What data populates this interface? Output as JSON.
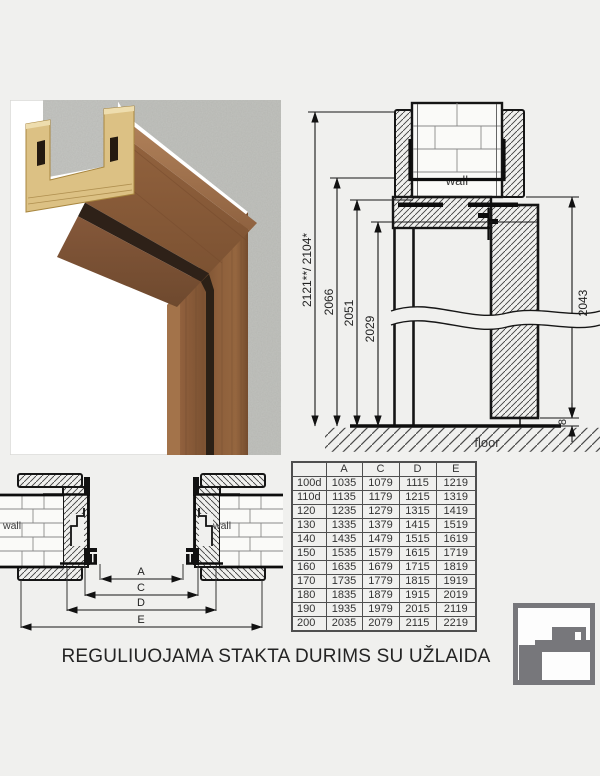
{
  "caption": "REGULIUOJAMA STAKTA DURIMS SU UŽLAIDA",
  "colors": {
    "background": "#f0f0ee",
    "line": "#161616",
    "logo_gray": "#77777b",
    "table_border": "#4f4f4f"
  },
  "section_view": {
    "wall_label": "wall",
    "floor_label": "floor",
    "dim_total": "2121**/ 2104*",
    "dim_frame_outer": "2066",
    "dim_frame_inner": "2051",
    "dim_opening": "2029",
    "dim_door": "2043",
    "dim_floor_gap": "8"
  },
  "plan_view": {
    "wall_label_left": "wall",
    "wall_label_right": "wall",
    "dim_a": "A",
    "dim_c": "C",
    "dim_d": "D",
    "dim_e": "E"
  },
  "table": {
    "columns": [
      "",
      "A",
      "C",
      "D",
      "E"
    ],
    "rows": [
      [
        "100d",
        "1035",
        "1079",
        "1115",
        "1219"
      ],
      [
        "110d",
        "1135",
        "1179",
        "1215",
        "1319"
      ],
      [
        "120",
        "1235",
        "1279",
        "1315",
        "1419"
      ],
      [
        "130",
        "1335",
        "1379",
        "1415",
        "1519"
      ],
      [
        "140",
        "1435",
        "1479",
        "1515",
        "1619"
      ],
      [
        "150",
        "1535",
        "1579",
        "1615",
        "1719"
      ],
      [
        "160",
        "1635",
        "1679",
        "1715",
        "1819"
      ],
      [
        "170",
        "1735",
        "1779",
        "1815",
        "1919"
      ],
      [
        "180",
        "1835",
        "1879",
        "1915",
        "2019"
      ],
      [
        "190",
        "1935",
        "1979",
        "2015",
        "2119"
      ],
      [
        "200",
        "2035",
        "2079",
        "2115",
        "2219"
      ]
    ]
  }
}
